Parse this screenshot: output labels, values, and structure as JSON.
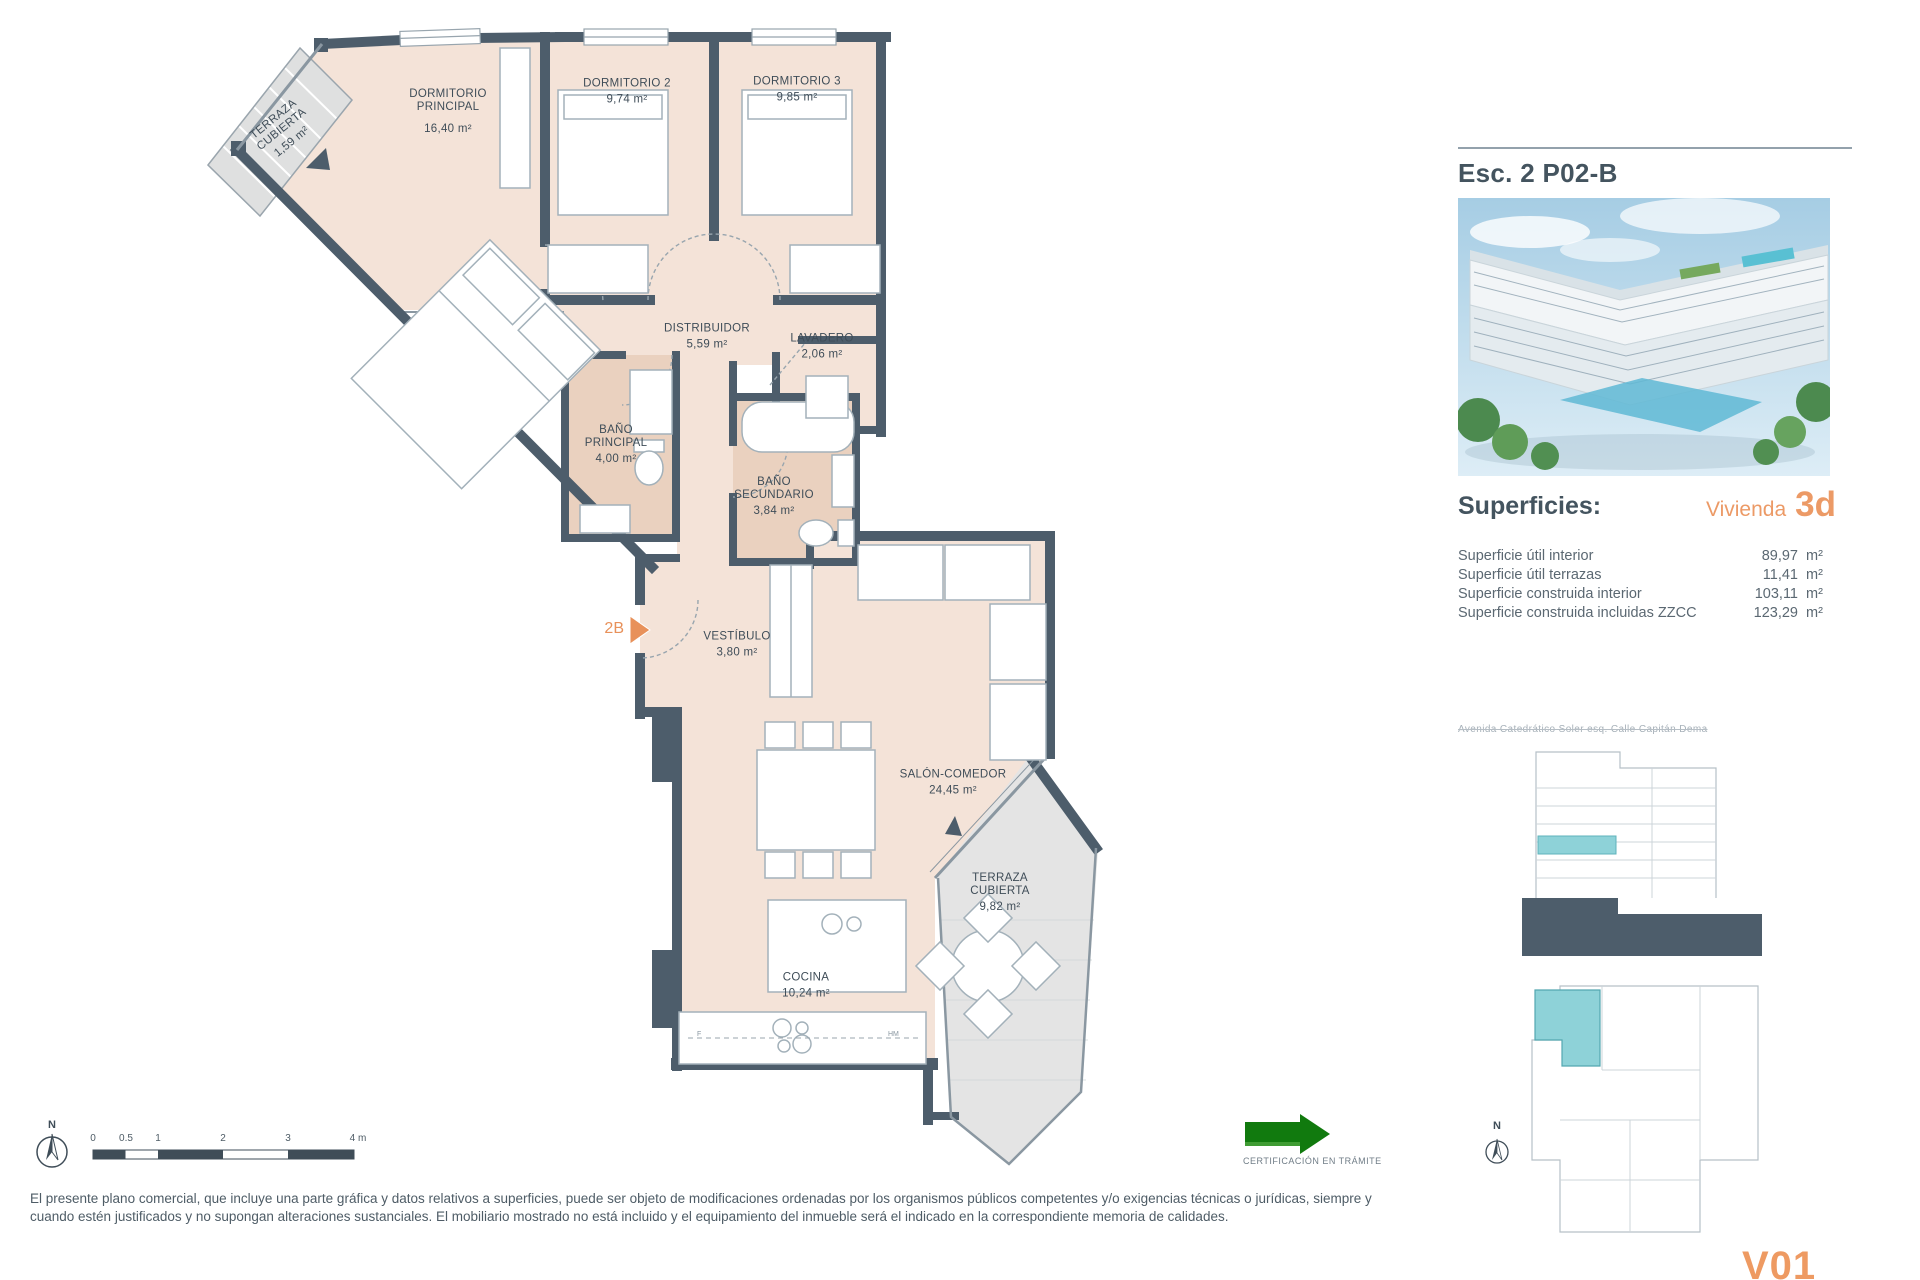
{
  "plan": {
    "rooms": [
      {
        "name": "TERRAZA CUBIERTA",
        "area": "1,59 m²"
      },
      {
        "name": "DORMITORIO PRINCIPAL",
        "area": "16,40 m²"
      },
      {
        "name": "DORMITORIO 2",
        "area": "9,74 m²"
      },
      {
        "name": "DORMITORIO 3",
        "area": "9,85 m²"
      },
      {
        "name": "DISTRIBUIDOR",
        "area": "5,59 m²"
      },
      {
        "name": "LAVADERO",
        "area": "2,06 m²"
      },
      {
        "name": "BAÑO PRINCIPAL",
        "area": "4,00 m²"
      },
      {
        "name": "BAÑO SECUNDARIO",
        "area": "3,84 m²"
      },
      {
        "name": "VESTÍBULO",
        "area": "3,80 m²"
      },
      {
        "name": "SALÓN-COMEDOR",
        "area": "24,45 m²"
      },
      {
        "name": "TERRAZA CUBIERTA",
        "area": "9,82 m²"
      },
      {
        "name": "COCINA",
        "area": "10,24 m²"
      }
    ],
    "entry_label": "2B",
    "kitchen_codes": [
      "F",
      "HM"
    ]
  },
  "scalebar": {
    "north_label": "N",
    "tick_labels": [
      "0",
      "0.5",
      "1",
      "2",
      "3",
      "4 m"
    ]
  },
  "certification": {
    "label": "CERTIFICACIÓN EN TRÁMITE"
  },
  "panel": {
    "title": "Esc. 2 P02-B",
    "superficies_title": "Superficies:",
    "vivienda_label": "Vivienda",
    "vivienda_value": "3d",
    "rows": [
      {
        "label": "Superficie útil interior",
        "value": "89,97",
        "unit": "m²"
      },
      {
        "label": "Superficie útil terrazas",
        "value": "11,41",
        "unit": "m²"
      },
      {
        "label": "Superficie construida interior",
        "value": "103,11",
        "unit": "m²"
      },
      {
        "label": "Superficie construida incluidas ZZCC",
        "value": "123,29",
        "unit": "m²"
      }
    ],
    "address": "Avenida Catedrático Soler esq. Calle Capitán Dema",
    "mini_north_label": "N",
    "version": "V01"
  },
  "footer": {
    "disclaimer_line1": "El presente plano comercial, que incluye una parte gráfica y datos relativos a superficies, puede ser objeto de modificaciones ordenadas por los organismos públicos competentes y/o exigencias técnicas o jurídicas, siempre y",
    "disclaimer_line2": "cuando estén justificados y no supongan alteraciones sustanciales. El mobiliario mostrado no está incluido y el equipamiento del inmueble será el indicado en la correspondiente memoria de calidades."
  },
  "colors": {
    "wall": "#4d5d6b",
    "floor": "#f4e3d8",
    "bath_floor": "#ead1bf",
    "terrace": "#e4e4e4",
    "accent_orange": "#ec9a66",
    "cert_green": "#117a0e",
    "highlight_teal": "#8ed2d8"
  }
}
